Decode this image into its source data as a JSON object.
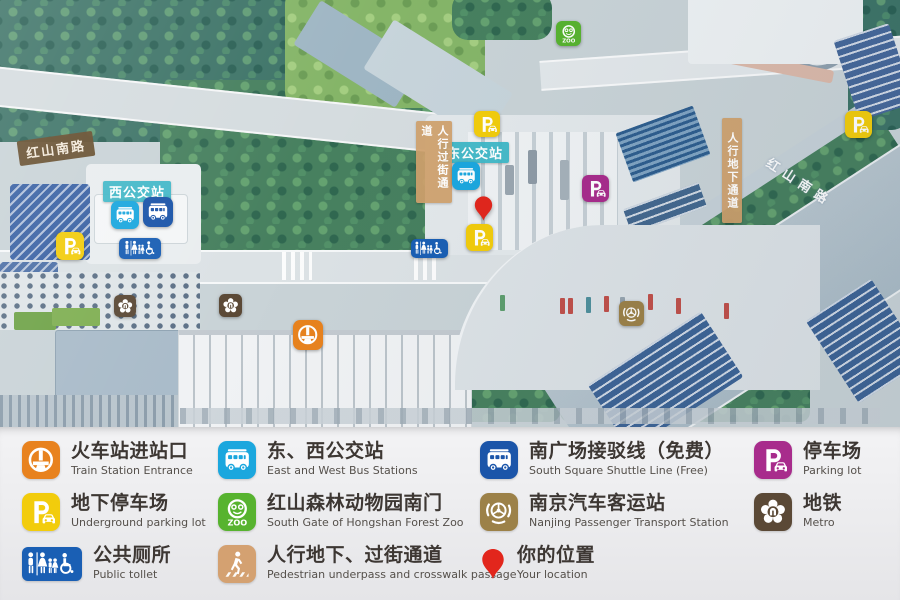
{
  "colors": {
    "railway": "#E8821E",
    "bus-light": "#1BA7DE",
    "bus-dark": "#1B55A9",
    "parking-yellow": "#F2CC0C",
    "parking-magenta": "#A82C8C",
    "zoo": "#57B32F",
    "transport": "#9C8148",
    "metro": "#5B4936",
    "toilet": "#1A5FB4",
    "pedestrian": "#D4A171",
    "pin": "#E2261C",
    "label-teal": "#3EB7C6",
    "label-brown": "#664D2D",
    "label-tan": "#D0A06C"
  },
  "map": {
    "road_labels": [
      {
        "id": "hongshan-south-road-west",
        "text": "红山南路",
        "style": "plate-brown",
        "x": 18,
        "y": 136
      },
      {
        "id": "hongshan-south-road-east",
        "text": "红山南路",
        "style": "road-paint",
        "x": 762,
        "y": 172
      }
    ],
    "station_labels": [
      {
        "id": "west-bus-station",
        "text": "西公交站",
        "x": 103,
        "y": 181
      },
      {
        "id": "east-bus-station",
        "text": "东公交站",
        "x": 441,
        "y": 142
      }
    ],
    "passage_labels": [
      {
        "id": "crosswalk-passage",
        "text": "人行过街通道",
        "x": 416,
        "y": 121,
        "h": 74
      },
      {
        "id": "underground-passage",
        "text": "人行地下通道",
        "x": 722,
        "y": 118,
        "h": 97
      }
    ],
    "markers": [
      {
        "type": "bus-light",
        "x": 111,
        "y": 201,
        "s": 28
      },
      {
        "type": "bus-dark",
        "x": 143,
        "y": 197,
        "s": 30
      },
      {
        "type": "parking-yellow",
        "x": 56,
        "y": 232,
        "s": 28
      },
      {
        "type": "toilet",
        "x": 119,
        "y": 238,
        "w": 42,
        "h": 21
      },
      {
        "type": "metro",
        "x": 114,
        "y": 295,
        "s": 22
      },
      {
        "type": "metro",
        "x": 219,
        "y": 294,
        "s": 23
      },
      {
        "type": "railway",
        "x": 293,
        "y": 320,
        "s": 30
      },
      {
        "type": "toilet",
        "x": 411,
        "y": 239,
        "w": 37,
        "h": 19
      },
      {
        "type": "zoo",
        "x": 556,
        "y": 21,
        "s": 25
      },
      {
        "type": "parking-yellow",
        "x": 474,
        "y": 111,
        "s": 26
      },
      {
        "type": "bus-light",
        "x": 452,
        "y": 162,
        "s": 28
      },
      {
        "type": "pin",
        "x": 473,
        "y": 195,
        "w": 21,
        "h": 27
      },
      {
        "type": "parking-yellow",
        "x": 466,
        "y": 224,
        "s": 27
      },
      {
        "type": "parking-magenta",
        "x": 582,
        "y": 175,
        "s": 27
      },
      {
        "type": "transport",
        "x": 619,
        "y": 301,
        "s": 25
      },
      {
        "type": "parking-yellow",
        "x": 845,
        "y": 111,
        "s": 27
      }
    ]
  },
  "legend": {
    "columns": [
      {
        "items": [
          {
            "type": "railway",
            "zh": "火车站进站口",
            "en": "Train Station Entrance"
          },
          {
            "type": "parking-yellow",
            "zh": "地下停车场",
            "en": "Underground parking lot"
          },
          {
            "type": "toilet",
            "zh": "公共厕所",
            "en": "Public tollet"
          }
        ]
      },
      {
        "items": [
          {
            "type": "bus-light",
            "zh": "东、西公交站",
            "en": "East and West Bus Stations"
          },
          {
            "type": "zoo",
            "zh": "红山森林动物园南门",
            "en": "South Gate of Hongshan Forest Zoo"
          },
          {
            "type": "pedestrian",
            "zh": "人行地下、过街通道",
            "en": "Pedestrian underpass and crosswalk passage"
          }
        ]
      },
      {
        "items": [
          {
            "type": "bus-dark",
            "zh": "南广场接驳线（免费）",
            "en": "South Square Shuttle Line (Free)"
          },
          {
            "type": "transport",
            "zh": "南京汽车客运站",
            "en": "Nanjing Passenger Transport Station"
          },
          {
            "type": "pin",
            "zh": "你的位置",
            "en": "Your location"
          }
        ]
      },
      {
        "items": [
          {
            "type": "parking-magenta",
            "zh": "停车场",
            "en": "Parking lot"
          },
          {
            "type": "metro",
            "zh": "地铁",
            "en": "Metro"
          }
        ]
      }
    ]
  }
}
